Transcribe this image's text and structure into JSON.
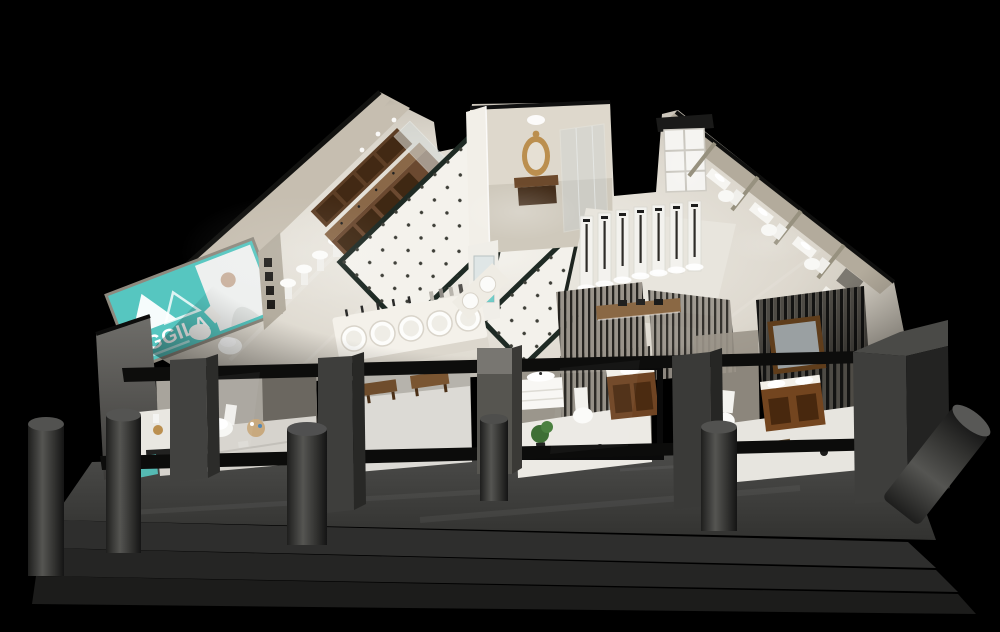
{
  "sign": {
    "brand": "AGGILA"
  },
  "colors": {
    "background": "#000000",
    "brand_teal": "#56c6c0",
    "accent_gold": "#bb8f4f",
    "wood_brown": "#6b4930",
    "floor_light": "#efede7",
    "walkway_gray": "#3f3f3d"
  }
}
